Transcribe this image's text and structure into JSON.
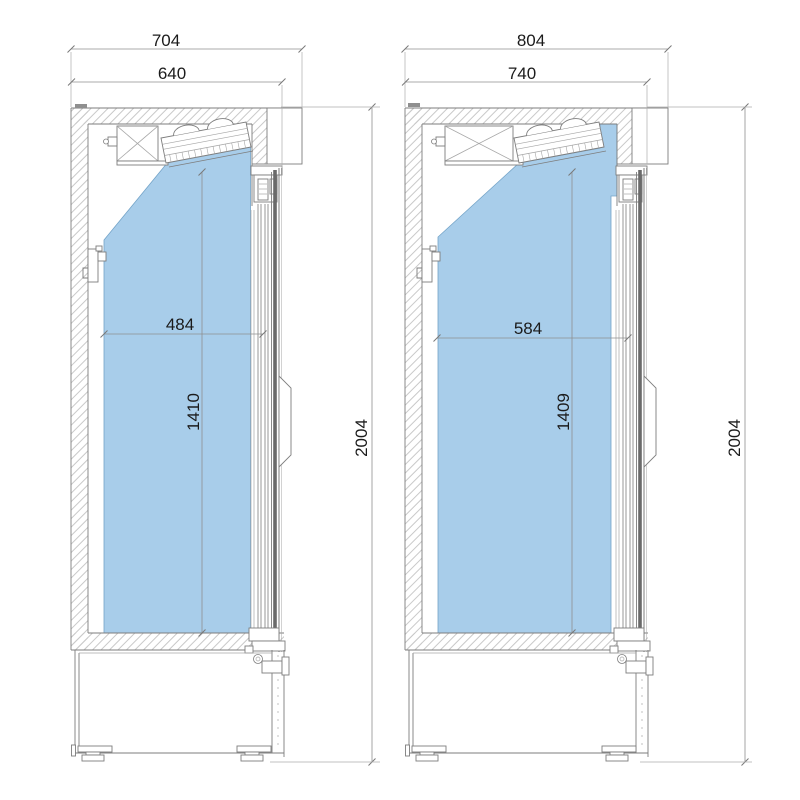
{
  "drawing": {
    "kind": "refrigerated-cabinet-cross-sections",
    "units": {
      "left": {
        "overall_width": "704",
        "cabinet_width": "640",
        "interior_width": "484",
        "interior_height": "1410",
        "overall_height": "2004"
      },
      "right": {
        "overall_width": "804",
        "cabinet_width": "740",
        "interior_width": "584",
        "interior_height": "1409",
        "overall_height": "2004"
      }
    },
    "colors": {
      "background": "#ffffff",
      "interior_fill": "#a8cdea",
      "interior_edge": "#74a4c8",
      "outline": "#7d7d7d",
      "light_line": "#a6a6a6",
      "dark_band": "#6a6a6a",
      "hatch": "#c9c9c9",
      "dim_line": "#8f8f8f",
      "ext_line": "#aeaeae",
      "text": "#1b1b1b"
    }
  }
}
